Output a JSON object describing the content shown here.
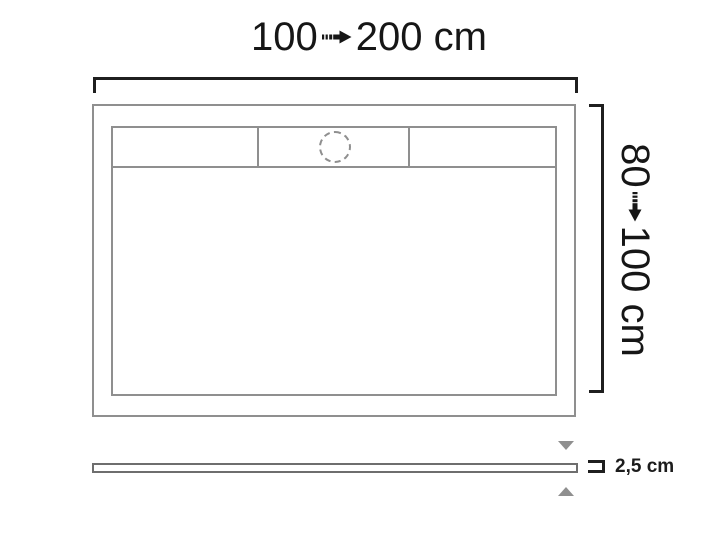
{
  "diagram": {
    "width_dimension": {
      "min": "100",
      "max": "200 cm"
    },
    "height_dimension": {
      "min": "80",
      "max": "100 cm"
    },
    "thickness": {
      "label": "2,5 cm"
    }
  },
  "icons": {
    "width_arrow": "striped-right-arrow-icon",
    "height_arrow": "striped-down-arrow-icon",
    "above_bar": "triangle-down-icon",
    "below_bar": "triangle-up-icon",
    "drain": "dashed-circle-drain-icon"
  },
  "colors": {
    "background": "#ffffff",
    "tray_outline": "#8f8f8f",
    "dimension_marks": "#1f1f1f",
    "label_text": "#161616",
    "triangles": "#8f8f8f",
    "side_bar_border": "#6e6e6e"
  }
}
